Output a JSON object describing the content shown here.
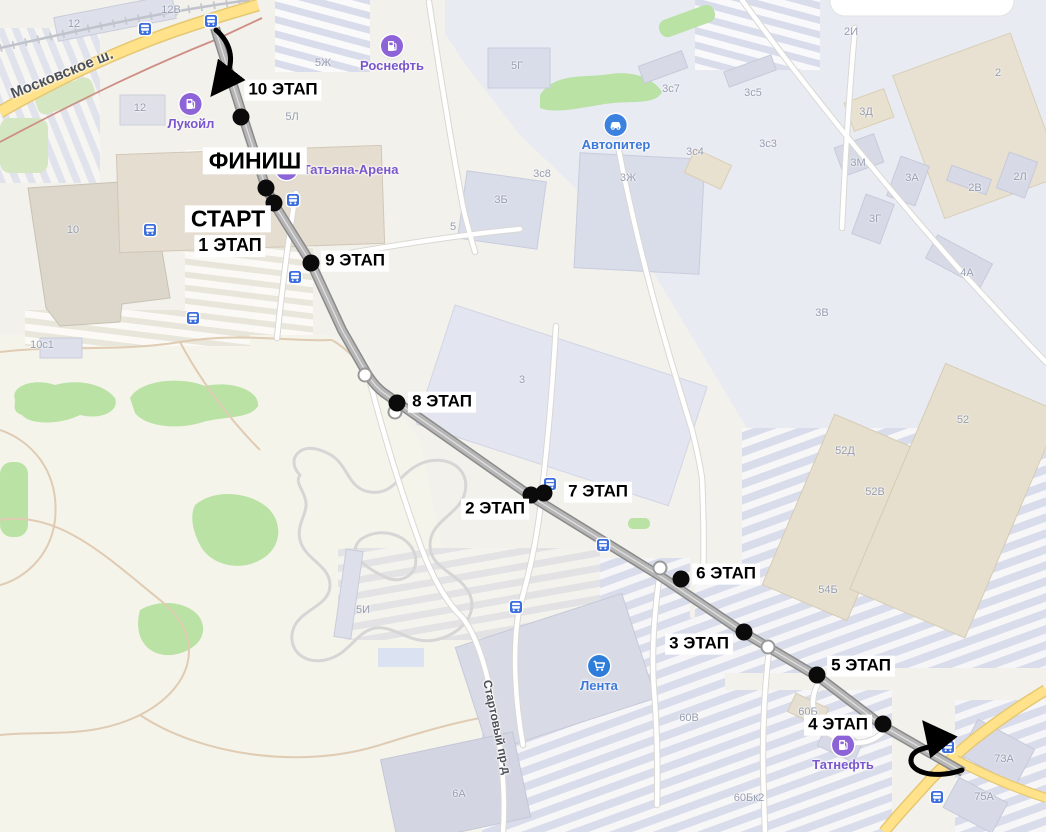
{
  "map": {
    "route_markers": [
      {
        "label": "10 ЭТАП",
        "dot_x": 241,
        "dot_y": 117,
        "label_cx": 283,
        "label_cy": 90,
        "size": "stage"
      },
      {
        "label": "ФИНИШ",
        "dot_x": 266,
        "dot_y": 188,
        "label_cx": 255,
        "label_cy": 161,
        "size": "big"
      },
      {
        "label": "СТАРТ",
        "dot_x": 274,
        "dot_y": 203,
        "label_cx": 228,
        "label_cy": 219,
        "size": "big"
      },
      {
        "label": "1 ЭТАП",
        "label_cx": 230,
        "label_cy": 246,
        "size": "mid"
      },
      {
        "label": "9 ЭТАП",
        "dot_x": 311,
        "dot_y": 263,
        "label_cx": 355,
        "label_cy": 261,
        "size": "stage"
      },
      {
        "label": "8 ЭТАП",
        "dot_x": 397,
        "dot_y": 403,
        "label_cx": 442,
        "label_cy": 402,
        "size": "stage"
      },
      {
        "label": "2 ЭТАП",
        "dot_x": 531,
        "dot_y": 495,
        "label_cx": 495,
        "label_cy": 509,
        "size": "stage"
      },
      {
        "label": "7 ЭТАП",
        "dot_x": 544,
        "dot_y": 493,
        "label_cx": 598,
        "label_cy": 492,
        "size": "stage"
      },
      {
        "label": "6 ЭТАП",
        "dot_x": 681,
        "dot_y": 579,
        "label_cx": 726,
        "label_cy": 574,
        "size": "stage"
      },
      {
        "label": "3 ЭТАП",
        "dot_x": 744,
        "dot_y": 632,
        "label_cx": 699,
        "label_cy": 644,
        "size": "stage"
      },
      {
        "label": "5 ЭТАП",
        "dot_x": 817,
        "dot_y": 675,
        "label_cx": 861,
        "label_cy": 666,
        "size": "stage"
      },
      {
        "label": "4 ЭТАП",
        "dot_x": 883,
        "dot_y": 724,
        "label_cx": 838,
        "label_cy": 725,
        "size": "stage"
      }
    ],
    "streets": [
      {
        "name": "Московское ш.",
        "cx": 62,
        "cy": 74,
        "rotate": -22,
        "font": 15
      },
      {
        "name": "Стартовый пр-д",
        "cx": 497,
        "cy": 727,
        "rotate": 78,
        "font": 12
      }
    ],
    "pois": [
      {
        "id": "lukoil",
        "label": "Лукойл",
        "x": 191,
        "y": 104,
        "accent": "#8d64d8",
        "text": "#7a56cc",
        "icon": "fuel-icon",
        "label_pos": "below"
      },
      {
        "id": "rosneft",
        "label": "Роснефть",
        "x": 392,
        "y": 46,
        "accent": "#8d64d8",
        "text": "#7a56cc",
        "icon": "fuel-icon",
        "label_pos": "below"
      },
      {
        "id": "tatyana-arena",
        "label": "Татьяна-Арена",
        "x": 337,
        "y": 169,
        "accent": "#8d64d8",
        "text": "#7a56cc",
        "icon": "arena-icon",
        "label_pos": "right"
      },
      {
        "id": "avtopiter",
        "label": "Автопитер",
        "x": 616,
        "y": 125,
        "accent": "#3b82e0",
        "text": "#3b78d8",
        "icon": "car-icon",
        "label_pos": "below"
      },
      {
        "id": "lenta",
        "label": "Лента",
        "x": 599,
        "y": 666,
        "accent": "#2f7dda",
        "text": "#3b78d8",
        "icon": "cart-icon",
        "label_pos": "below"
      },
      {
        "id": "tatneft",
        "label": "Татнефть",
        "x": 843,
        "y": 745,
        "accent": "#8d64d8",
        "text": "#7a56cc",
        "icon": "fuel-icon",
        "label_pos": "below"
      }
    ],
    "building_labels": [
      {
        "text": "12В",
        "x": 171,
        "y": 10
      },
      {
        "text": "12",
        "x": 74,
        "y": 24
      },
      {
        "text": "12",
        "x": 140,
        "y": 108
      },
      {
        "text": "10",
        "x": 73,
        "y": 230
      },
      {
        "text": "10с1",
        "x": 42,
        "y": 345
      },
      {
        "text": "5Ж",
        "x": 323,
        "y": 63
      },
      {
        "text": "5Л",
        "x": 292,
        "y": 117
      },
      {
        "text": "5Г",
        "x": 517,
        "y": 66
      },
      {
        "text": "5",
        "x": 453,
        "y": 227
      },
      {
        "text": "3Б",
        "x": 501,
        "y": 200
      },
      {
        "text": "3с8",
        "x": 542,
        "y": 174
      },
      {
        "text": "3Ж",
        "x": 628,
        "y": 178
      },
      {
        "text": "3с7",
        "x": 671,
        "y": 89
      },
      {
        "text": "3с5",
        "x": 753,
        "y": 93
      },
      {
        "text": "3с4",
        "x": 695,
        "y": 152
      },
      {
        "text": "3с3",
        "x": 768,
        "y": 144
      },
      {
        "text": "3Д",
        "x": 866,
        "y": 112
      },
      {
        "text": "3М",
        "x": 858,
        "y": 163
      },
      {
        "text": "3А",
        "x": 912,
        "y": 178
      },
      {
        "text": "3Г",
        "x": 875,
        "y": 219
      },
      {
        "text": "2И",
        "x": 851,
        "y": 32
      },
      {
        "text": "2",
        "x": 998,
        "y": 73
      },
      {
        "text": "2В",
        "x": 975,
        "y": 188
      },
      {
        "text": "2Л",
        "x": 1020,
        "y": 177
      },
      {
        "text": "4А",
        "x": 967,
        "y": 273
      },
      {
        "text": "3В",
        "x": 822,
        "y": 313
      },
      {
        "text": "52",
        "x": 963,
        "y": 420
      },
      {
        "text": "52Д",
        "x": 845,
        "y": 451
      },
      {
        "text": "52В",
        "x": 875,
        "y": 492
      },
      {
        "text": "54Б",
        "x": 828,
        "y": 590
      },
      {
        "text": "5И",
        "x": 363,
        "y": 610
      },
      {
        "text": "3",
        "x": 522,
        "y": 380
      },
      {
        "text": "60В",
        "x": 689,
        "y": 718
      },
      {
        "text": "60Б",
        "x": 808,
        "y": 712
      },
      {
        "text": "60Бк2",
        "x": 749,
        "y": 798
      },
      {
        "text": "6А",
        "x": 459,
        "y": 794
      },
      {
        "text": "73А",
        "x": 1004,
        "y": 759
      },
      {
        "text": "75А",
        "x": 984,
        "y": 797
      }
    ],
    "bus_stops": [
      {
        "x": 145,
        "y": 29
      },
      {
        "x": 211,
        "y": 21
      },
      {
        "x": 293,
        "y": 200
      },
      {
        "x": 150,
        "y": 230
      },
      {
        "x": 295,
        "y": 277
      },
      {
        "x": 193,
        "y": 318
      },
      {
        "x": 550,
        "y": 484
      },
      {
        "x": 603,
        "y": 545
      },
      {
        "x": 516,
        "y": 607
      },
      {
        "x": 948,
        "y": 747
      },
      {
        "x": 937,
        "y": 797
      }
    ],
    "junctions": [
      {
        "x": 365,
        "y": 375
      },
      {
        "x": 395,
        "y": 412
      },
      {
        "x": 660,
        "y": 568
      },
      {
        "x": 768,
        "y": 647
      }
    ],
    "colors": {
      "stage_dot": "#0b0b0b",
      "chip_bg": "#ffffff",
      "bus_blue": "#3c6fdd",
      "poi_purple": "#8d64d8",
      "poi_blue": "#3b82e0",
      "highway_yellow": "#ffe28a",
      "route_gray": "#8a8a8a",
      "green": "#b9e2a4"
    }
  }
}
